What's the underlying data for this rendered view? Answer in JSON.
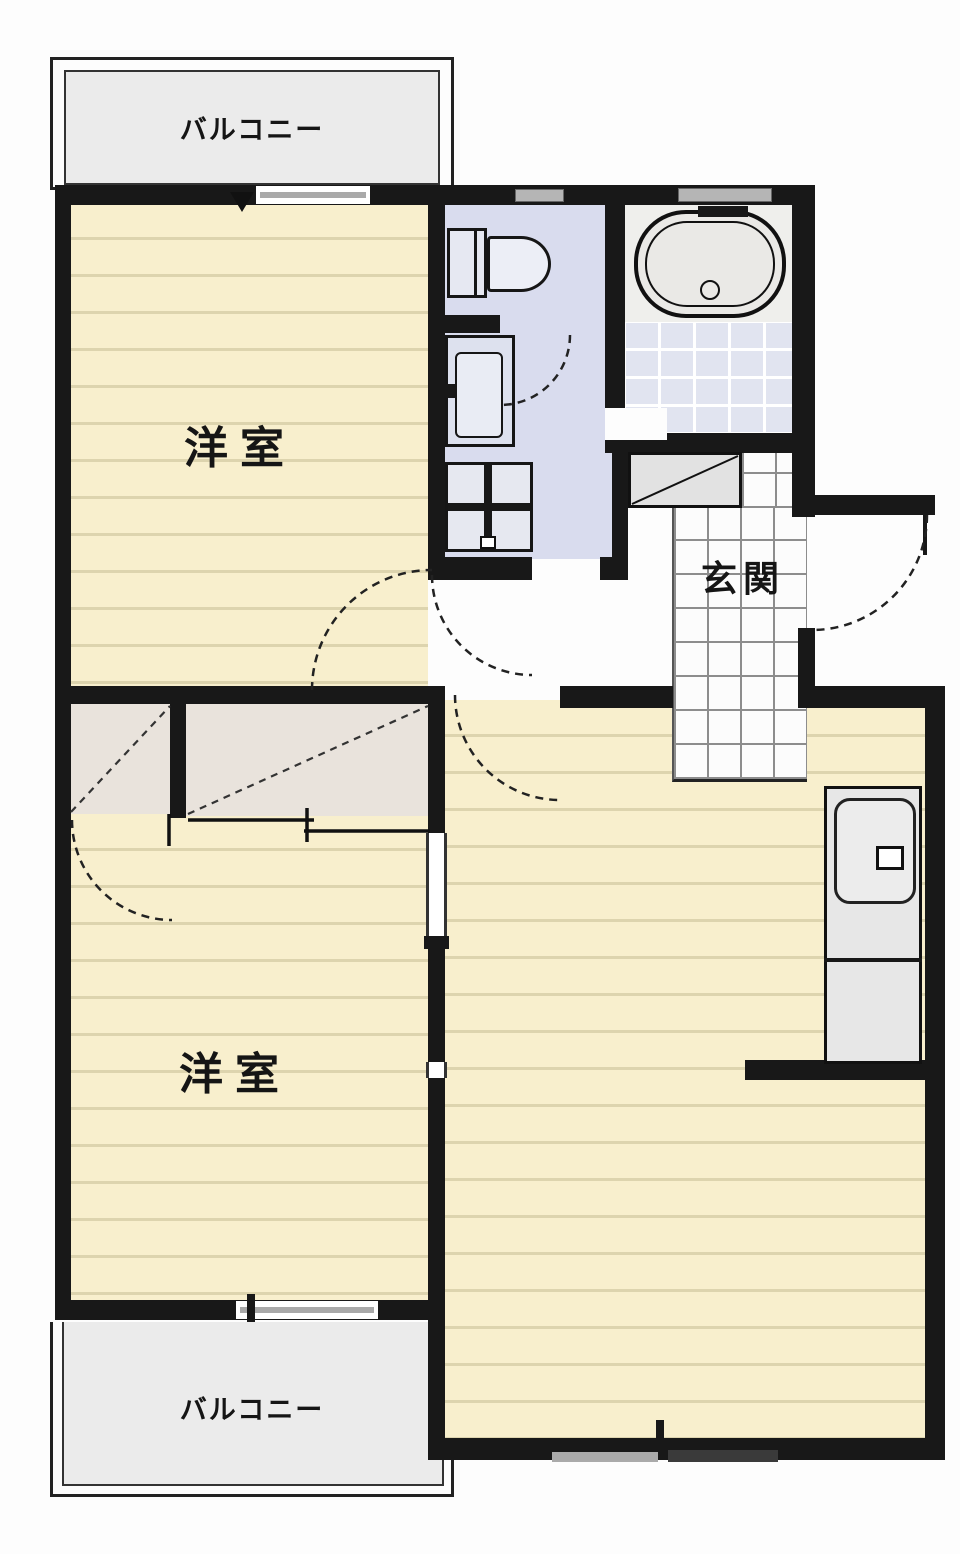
{
  "labels": {
    "balcony_top": "バルコニー",
    "balcony_bottom": "バルコニー",
    "bedroom_upper": "洋室",
    "bedroom_lower": "洋室",
    "entrance": "玄関"
  },
  "colors": {
    "wall": "#181818",
    "floor": "#f8efcd",
    "floor_stripe": "#ddd4ae",
    "balcony": "#ebebeb",
    "washroom": "#d9dcee",
    "bath_tile": "#e1e4f0",
    "closet": "#e9e3dc",
    "entrance_tile": "#fcfcfc",
    "counter": "#e7e7e7",
    "fixture_fill": "#eceef6"
  },
  "icons": {
    "toilet": "toilet-fixture",
    "bathtub": "bathtub-fixture",
    "vanity": "vanity-fixture",
    "washer_pan": "washer-pan-fixture",
    "kitchen_sink": "kitchen-sink-fixture",
    "shoe_cabinet": "shoe-cabinet-fixture"
  }
}
